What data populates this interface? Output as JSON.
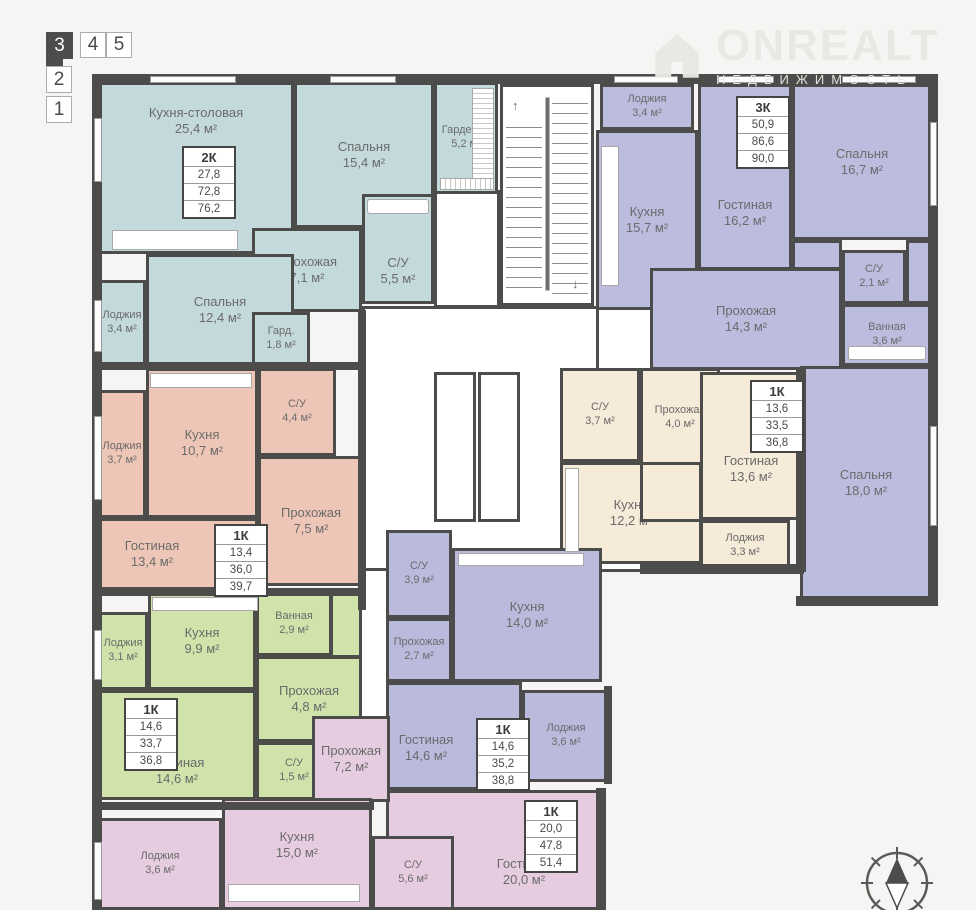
{
  "floor_selector": {
    "buttons": [
      "3",
      "4",
      "5",
      "2",
      "1"
    ],
    "selected": "3"
  },
  "watermark": {
    "brand": "ONREALT",
    "subtitle": "НЕДВИЖИМОСТЬ"
  },
  "palette": {
    "wall": "#4c4c4a",
    "teal": "#c3d9dc",
    "purple": "#bcbcdf",
    "beige": "#f6ead8",
    "salmon": "#eec6b7",
    "green": "#cfe3ab",
    "violet": "#babadd",
    "pink": "#e6cce0"
  },
  "apartments": [
    {
      "name": "teal-2k",
      "card": {
        "type": "2К",
        "a1": "27,8",
        "a2": "72,8",
        "a3": "76,2"
      },
      "rooms": [
        {
          "label": "Кухня-столовая",
          "area": "25,4 м²"
        },
        {
          "label": "Спальня",
          "area": "15,4 м²"
        },
        {
          "label": "Гардероб",
          "area": "5,2 м²"
        },
        {
          "label": "Прохожая",
          "area": "7,1 м²"
        },
        {
          "label": "С/У",
          "area": "5,5 м²"
        },
        {
          "label": "Спальня",
          "area": "12,4 м²"
        },
        {
          "label": "Лоджия",
          "area": "3,4 м²"
        },
        {
          "label": "Гард.",
          "area": "1,8 м²"
        }
      ]
    },
    {
      "name": "purple-3k",
      "card": {
        "type": "3К",
        "a1": "50,9",
        "a2": "86,6",
        "a3": "90,0"
      },
      "rooms": [
        {
          "label": "Лоджия",
          "area": "3,4 м²"
        },
        {
          "label": "Кухня",
          "area": "15,7 м²"
        },
        {
          "label": "Гостиная",
          "area": "16,2 м²"
        },
        {
          "label": "Спальня",
          "area": "16,7 м²"
        },
        {
          "label": "Прохожая",
          "area": "14,3 м²"
        },
        {
          "label": "С/У",
          "area": "2,1 м²"
        },
        {
          "label": "Ванная",
          "area": "3,6 м²"
        },
        {
          "label": "Спальня",
          "area": "18,0 м²"
        }
      ]
    },
    {
      "name": "beige-1k",
      "card": {
        "type": "1К",
        "a1": "13,6",
        "a2": "33,5",
        "a3": "36,8"
      },
      "rooms": [
        {
          "label": "С/У",
          "area": "3,7 м²"
        },
        {
          "label": "Прохожая",
          "area": "4,0 м²"
        },
        {
          "label": "Гостиная",
          "area": "13,6 м²"
        },
        {
          "label": "Кухня",
          "area": "12,2 м²"
        },
        {
          "label": "Лоджия",
          "area": "3,3 м²"
        }
      ]
    },
    {
      "name": "salmon-1k",
      "card": {
        "type": "1К",
        "a1": "13,4",
        "a2": "36,0",
        "a3": "39,7"
      },
      "rooms": [
        {
          "label": "Лоджия",
          "area": "3,7 м²"
        },
        {
          "label": "Кухня",
          "area": "10,7 м²"
        },
        {
          "label": "С/У",
          "area": "4,4 м²"
        },
        {
          "label": "Прохожая",
          "area": "7,5 м²"
        },
        {
          "label": "Гостиная",
          "area": "13,4 м²"
        }
      ]
    },
    {
      "name": "green-1k",
      "card": {
        "type": "1К",
        "a1": "14,6",
        "a2": "33,7",
        "a3": "36,8"
      },
      "rooms": [
        {
          "label": "Лоджия",
          "area": "3,1 м²"
        },
        {
          "label": "Кухня",
          "area": "9,9 м²"
        },
        {
          "label": "Ванная",
          "area": "2,9 м²"
        },
        {
          "label": "Прохожая",
          "area": "4,8 м²"
        },
        {
          "label": "С/У",
          "area": "1,5 м²"
        },
        {
          "label": "Гостиная",
          "area": "14,6 м²"
        }
      ]
    },
    {
      "name": "violet-1k",
      "card": {
        "type": "1К",
        "a1": "14,6",
        "a2": "35,2",
        "a3": "38,8"
      },
      "rooms": [
        {
          "label": "С/У",
          "area": "3,9 м²"
        },
        {
          "label": "Кухня",
          "area": "14,0 м²"
        },
        {
          "label": "Прохожая",
          "area": "2,7 м²"
        },
        {
          "label": "Гостиная",
          "area": "14,6 м²"
        },
        {
          "label": "Лоджия",
          "area": "3,6 м²"
        }
      ]
    },
    {
      "name": "pink-1k",
      "card": {
        "type": "1К",
        "a1": "20,0",
        "a2": "47,8",
        "a3": "51,4"
      },
      "rooms": [
        {
          "label": "Прохожая",
          "area": "7,2 м²"
        },
        {
          "label": "Лоджия",
          "area": "3,6 м²"
        },
        {
          "label": "Кухня",
          "area": "15,0 м²"
        },
        {
          "label": "С/У",
          "area": "5,6 м²"
        },
        {
          "label": "Гостиная",
          "area": "20,0 м²"
        }
      ]
    }
  ]
}
